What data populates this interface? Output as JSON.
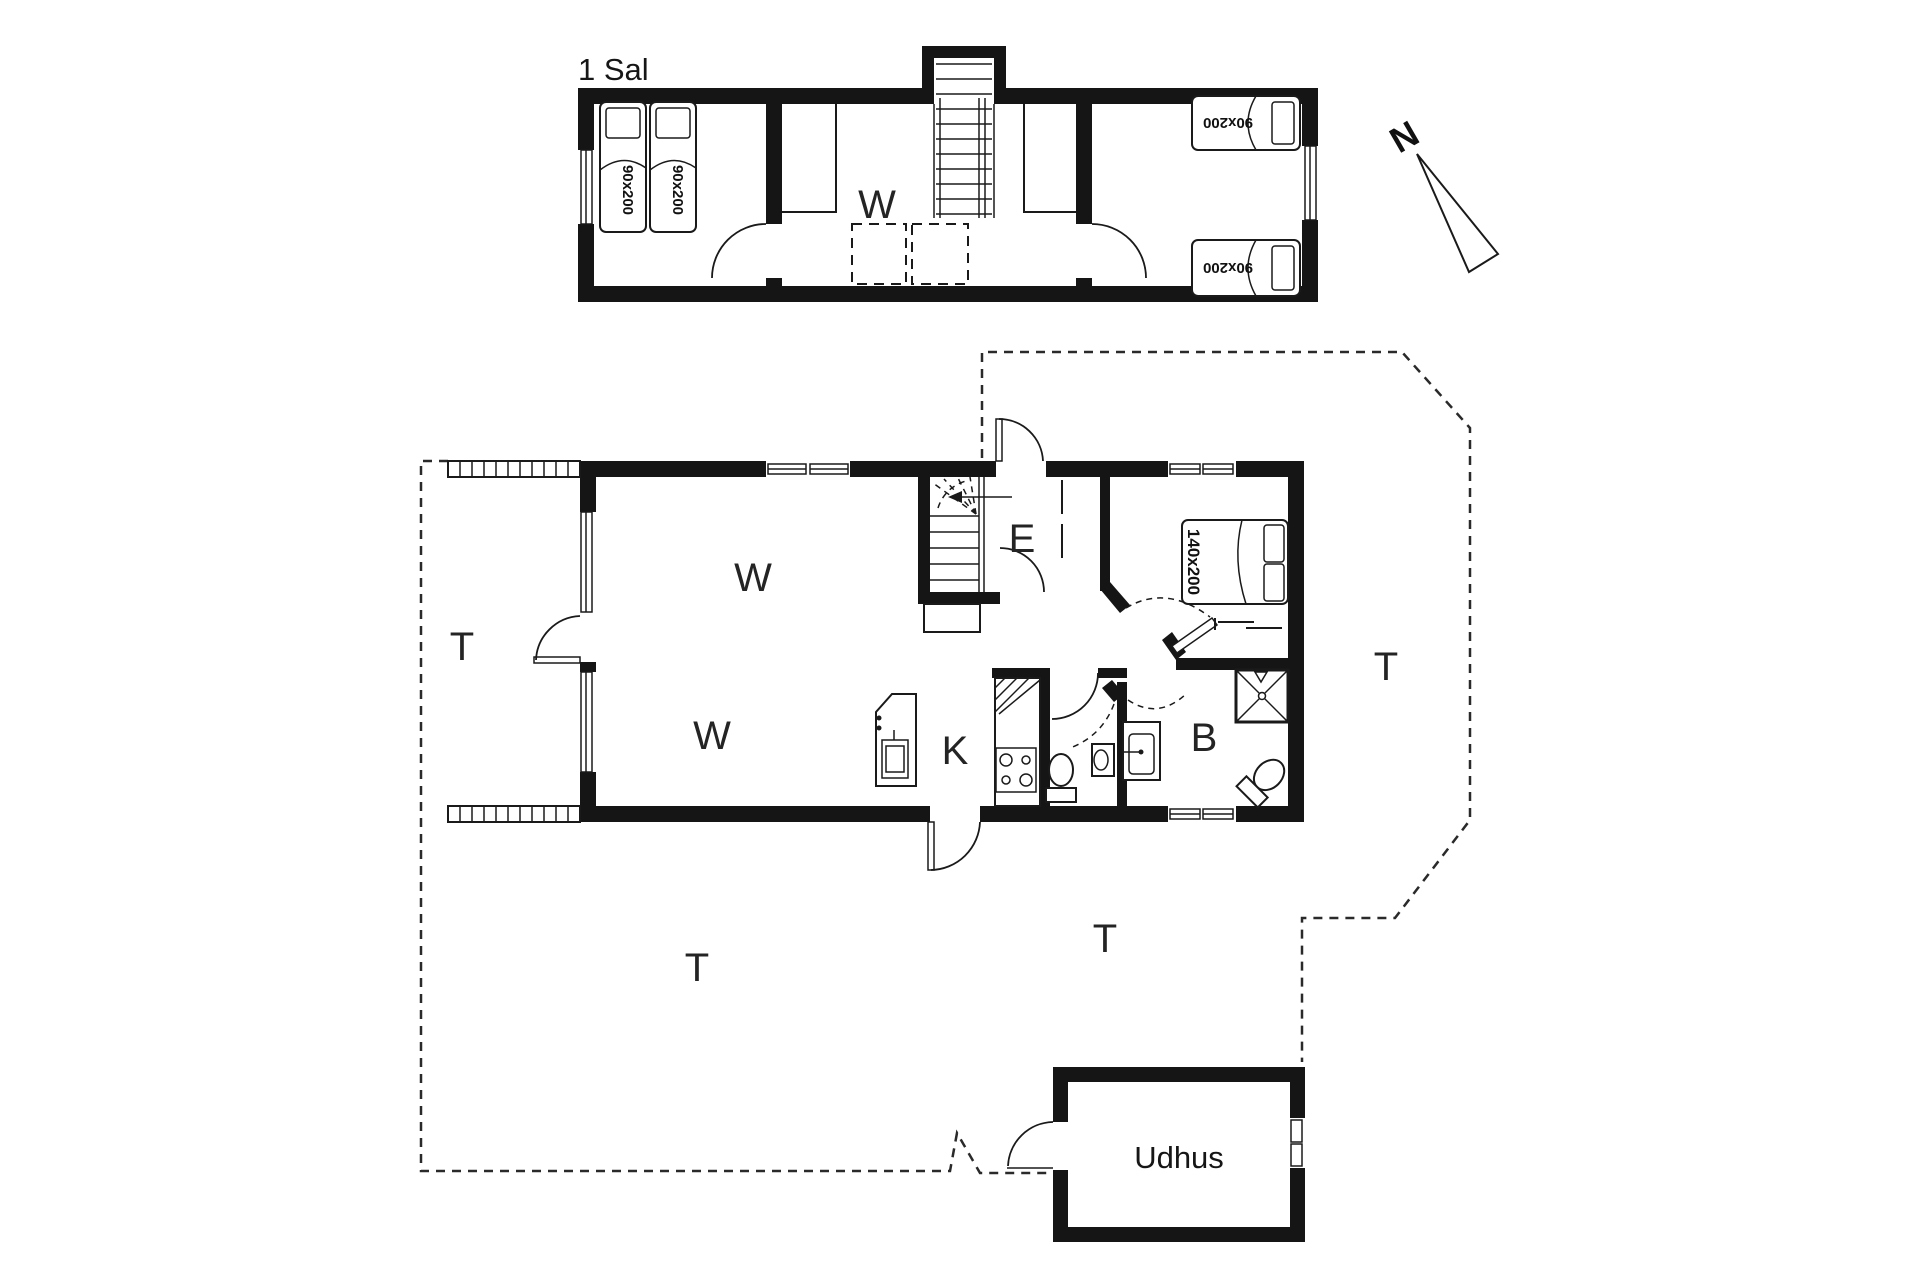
{
  "plan": {
    "first_floor": {
      "title": "1 Sal",
      "hall_label": "W",
      "bed_labels": [
        "90x200",
        "90x200",
        "90x200",
        "90x200"
      ]
    },
    "ground_floor": {
      "living_label_top": "W",
      "living_label_bottom": "W",
      "entry_label": "E",
      "kitchen_label": "K",
      "bath_label": "B",
      "bed_label": "140x200",
      "terrace_left": "T",
      "terrace_right": "T",
      "terrace_bottom_left": "T",
      "terrace_bottom_right": "T"
    },
    "outbuilding": {
      "title": "Udhus"
    },
    "compass": {
      "north_label": "N"
    },
    "colors": {
      "ink": "#151515",
      "background": "#ffffff"
    }
  }
}
